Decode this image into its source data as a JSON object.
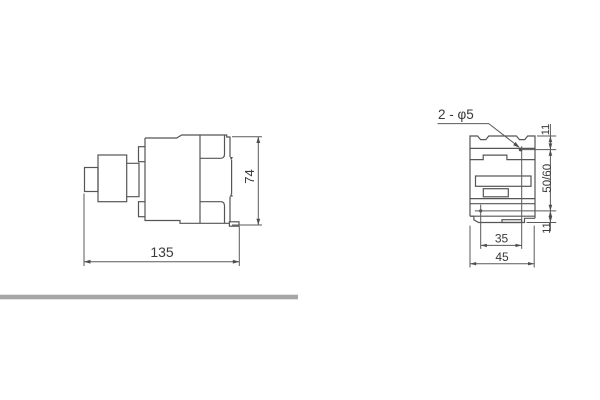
{
  "drawing": {
    "title": "contactor-dimension-drawing",
    "line_color": "#555555",
    "text_color": "#3a3a3a",
    "separator_bar_color": "#a6a6a6",
    "side_view": {
      "length_label": "135",
      "height_label": "74"
    },
    "front_view": {
      "holes_label": "2 - φ5",
      "top_offset_label": "11",
      "mount_spacing_label": "50/60",
      "bottom_offset_label": "11",
      "hole_span_label": "35",
      "width_label": "45"
    }
  }
}
